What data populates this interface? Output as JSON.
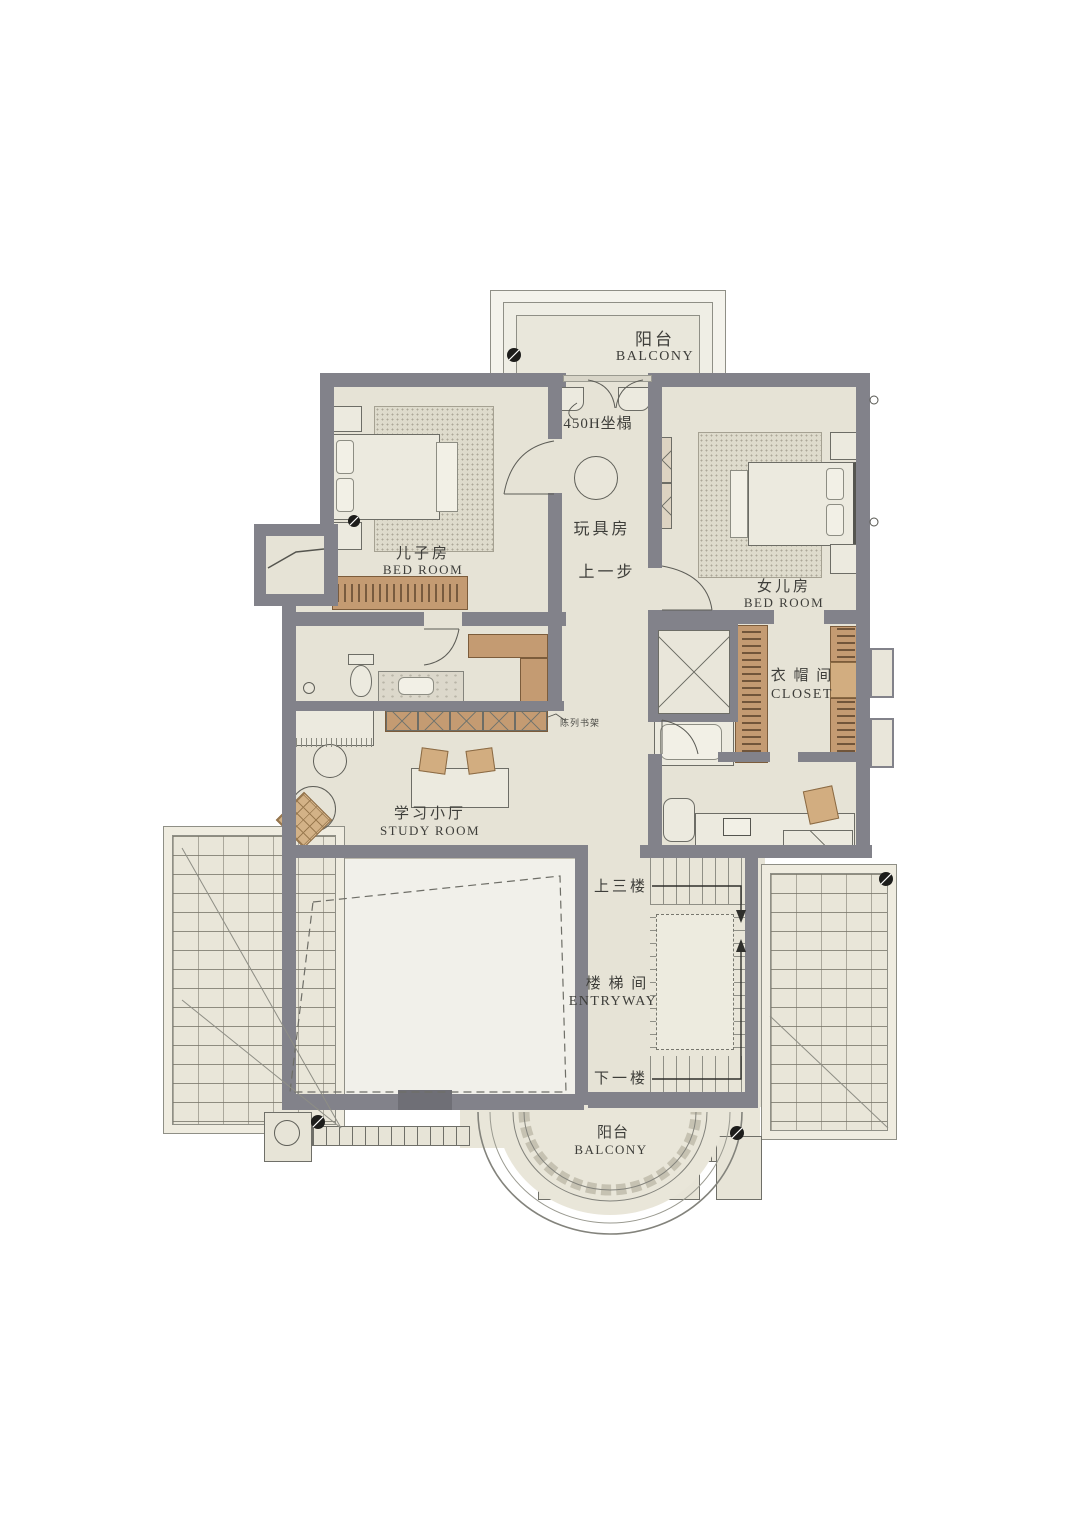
{
  "labels": {
    "balcony_top": {
      "zh": "阳台",
      "en": "BALCONY"
    },
    "seat_note": "450H坐榻",
    "playroom": "玩具房",
    "step_note": "上一步",
    "son_room": {
      "zh": "儿子房",
      "en": "BED  ROOM"
    },
    "daughter_room": {
      "zh": "女儿房",
      "en": "BED  ROOM"
    },
    "closet": {
      "zh": "衣 帽 间",
      "en": "CLOSET"
    },
    "study": {
      "zh": "学习小厅",
      "en": "STUDY  ROOM"
    },
    "shelf_note": "陈列书架",
    "stairs_up": "上三楼",
    "stairwell": {
      "zh": "楼 梯 间",
      "en": "ENTRYWAY"
    },
    "stairs_down": "下一楼",
    "balcony_bottom": {
      "zh": "阳台",
      "en": "BALCONY"
    }
  },
  "colors": {
    "floor": "#e6e3d6",
    "void": "#f1f0ea",
    "wall": "#82828a",
    "wood": "#c49b72",
    "text": "#3e3e3a"
  }
}
